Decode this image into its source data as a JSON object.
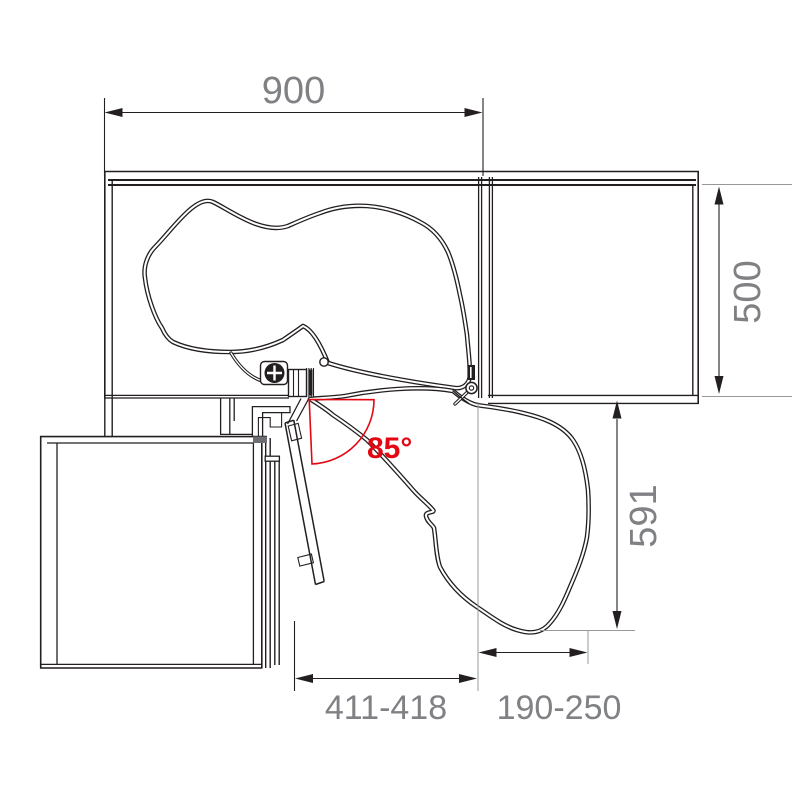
{
  "dimensions": {
    "top_width": "900",
    "right_depth": "500",
    "extended_depth": "591",
    "bottom_left_range": "411-418",
    "bottom_right_range": "190-250"
  },
  "angle": {
    "opening_label": "85°"
  },
  "colors": {
    "line": "#231f20",
    "dim_text": "#808184",
    "accent_red": "#e30613",
    "ext_line": "#97989b",
    "background": "#ffffff"
  }
}
